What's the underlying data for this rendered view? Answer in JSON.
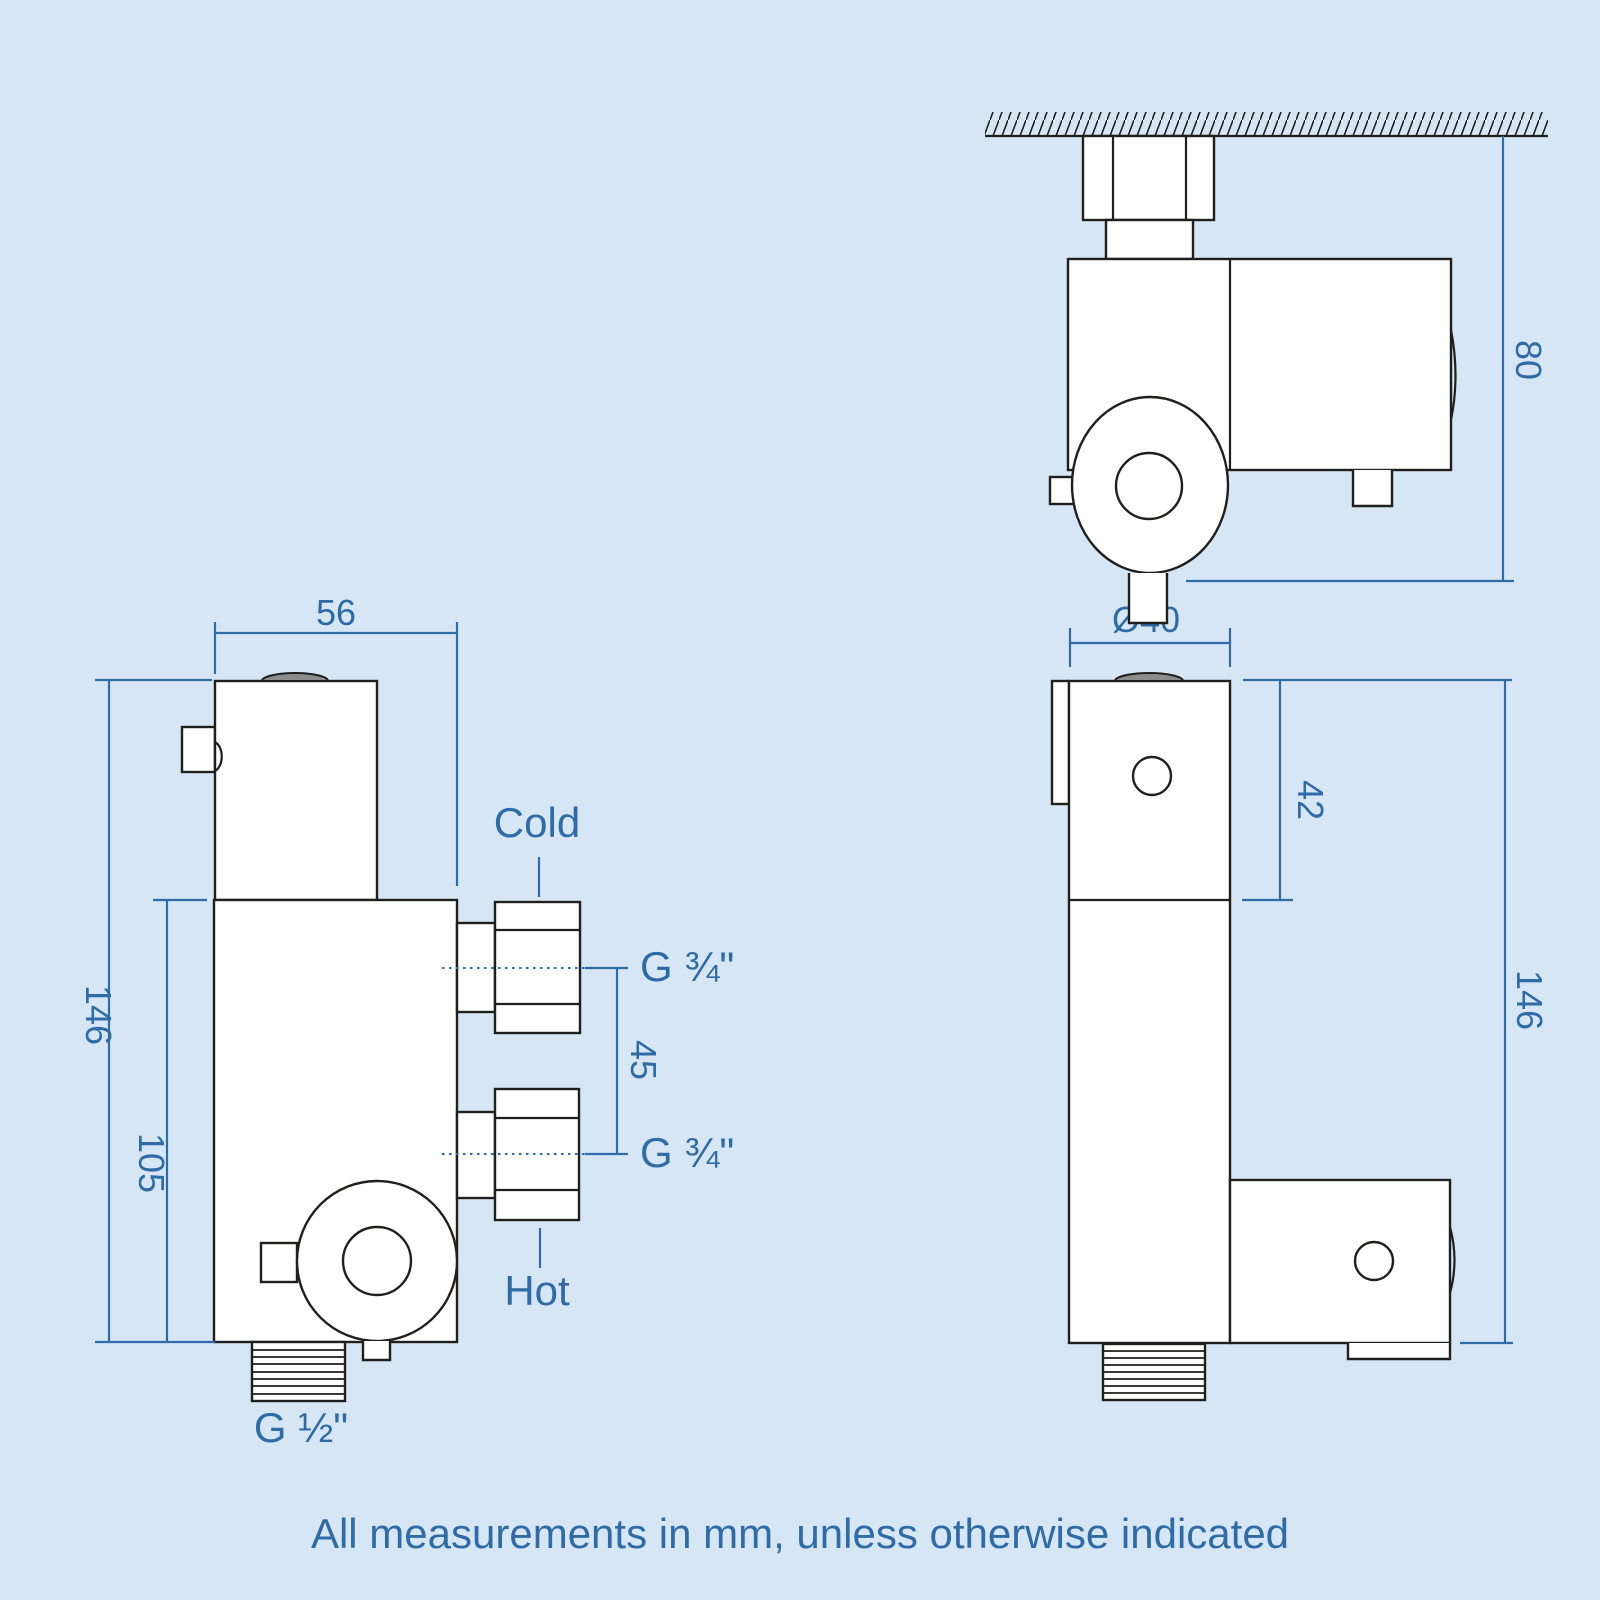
{
  "colors": {
    "background": "#d6e6f4",
    "line_dark": "#1f1f1d",
    "accent_blue": "#2f6ba6",
    "shape_fill": "#ffffff",
    "cap_gray": "#8c8c8c"
  },
  "caption": "All measurements in mm, unless otherwise indicated",
  "front_view": {
    "width_mm": "56",
    "total_height_mm": "146",
    "lower_height_mm": "105",
    "port_spacing_mm": "45",
    "cold_label": "Cold",
    "hot_label": "Hot",
    "cold_thread": "G ¾\"",
    "hot_thread": "G ¾\"",
    "outlet_thread": "G ½\""
  },
  "side_view": {
    "diameter_mm": "Ø40",
    "cartridge_height_mm": "42",
    "total_height_mm": "146"
  },
  "top_view": {
    "depth_mm": "80"
  }
}
